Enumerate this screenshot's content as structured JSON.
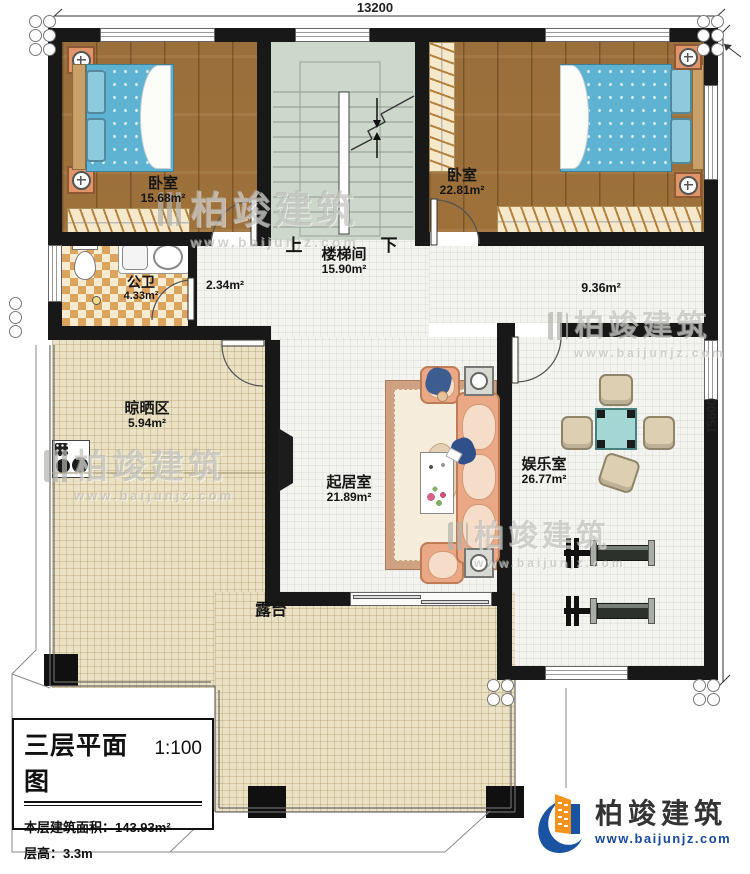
{
  "dimensions": {
    "top": "13200",
    "right": "15600"
  },
  "rooms": {
    "bedroom_left": {
      "name": "卧室",
      "area": "15.68m²"
    },
    "bedroom_right": {
      "name": "卧室",
      "area": "22.81m²"
    },
    "stairwell": {
      "name": "楼梯间",
      "area": "15.90m²",
      "up": "上",
      "down": "下"
    },
    "bathroom": {
      "name": "公卫",
      "area": "4.33m²"
    },
    "hall": {
      "area": "2.34m²"
    },
    "corridor": {
      "area": "9.36m²"
    },
    "drying": {
      "name": "晾晒区",
      "area": "5.94m²"
    },
    "living": {
      "name": "起居室",
      "area": "21.89m²"
    },
    "entertainment": {
      "name": "娱乐室",
      "area": "26.77m²"
    },
    "terrace": {
      "name": "露台"
    }
  },
  "title_block": {
    "title": "三层平面图",
    "scale": "1:100",
    "area_line": "本层建筑面积：143.93m²",
    "height_line": "层高：3.3m"
  },
  "logo": {
    "name": "柏竣建筑",
    "url": "www.baijunjz.com"
  },
  "watermark": {
    "name": "柏竣建筑",
    "url": "www.baijunjz.com"
  },
  "colors": {
    "wall": "#181818",
    "wood_floor": "#a97c44",
    "bed_blue": "#5fb3d2",
    "stair_floor": "#cdd7cc",
    "beige_tile": "#ebe2c5",
    "sofa_peach": "#eaa887",
    "mahjong_teal": "#a4d6d3",
    "logo_blue": "#1a53a1",
    "logo_orange": "#f6921e"
  }
}
